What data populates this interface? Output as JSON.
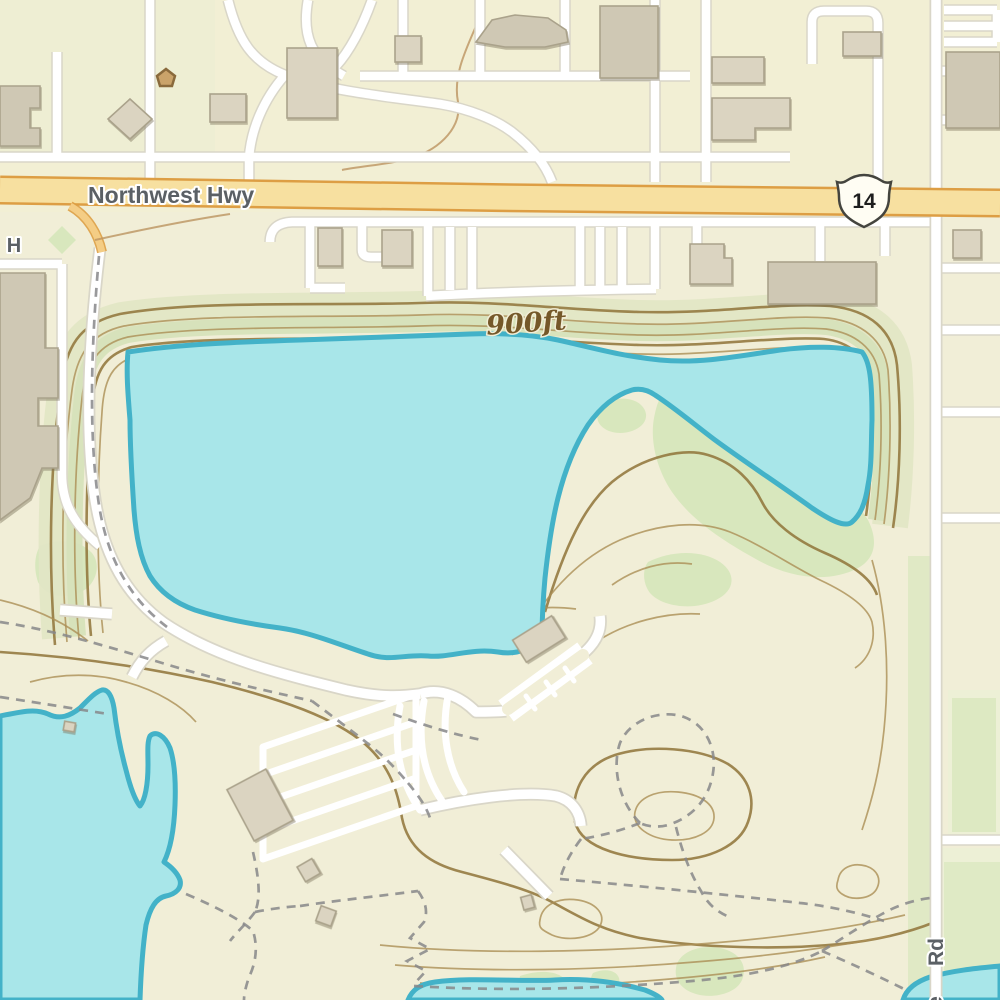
{
  "map": {
    "labels": {
      "highway_name": "Northwest Hwy",
      "route_number": "14",
      "elevation": "900ft",
      "right_road": "Rd",
      "right_road_partial": "e",
      "left_edge_partial": "H"
    },
    "colors": {
      "land": "#f1eed7",
      "land_top_tint": "#f3f0d2",
      "land_left_tint": "#e9edd2",
      "water_fill": "#a8e6e9",
      "water_stroke": "#43b2c8",
      "road_fill": "#ffffff",
      "road_casing": "#d9d6c8",
      "highway_fill": "#f7e0a0",
      "highway_casing": "#dd9e44",
      "ramp_fill": "#f4cd85",
      "building_fill": "#dbd4c1",
      "building_stroke": "#aaa28b",
      "building_dark_fill": "#cfc8b4",
      "contour": "#ab8e55",
      "contour_index": "#8f7338",
      "contour_label": "#755829",
      "vegetation": "#d8e7bd",
      "veg_band": "#e2e6c5",
      "veg_shore": "#d6e2ba",
      "block_tint": "#edf0d6",
      "trail": "#87878a",
      "label_text": "#5b6065",
      "shield_fill": "#fffdf3",
      "shield_stroke": "#44443e"
    }
  }
}
